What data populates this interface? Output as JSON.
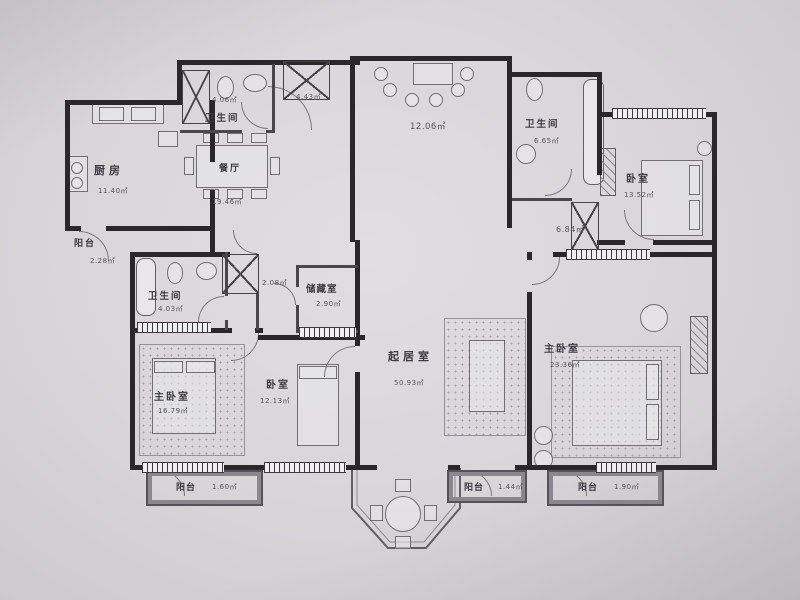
{
  "meta": {
    "kind": "residential floor plan",
    "units": "㎡"
  },
  "palette": {
    "paper": "#d9d6da",
    "wall": "#2a272a",
    "thin_line": "#716e76",
    "text": "#45444c"
  },
  "rooms": [
    {
      "id": "kitchen",
      "name": "厨房",
      "area": "11.40㎡"
    },
    {
      "id": "balcony-west",
      "name": "阳台",
      "area": "2.28㎡"
    },
    {
      "id": "bathroom-north",
      "name": "卫生间",
      "area": "4.06㎡"
    },
    {
      "id": "foyer",
      "name": "",
      "area": "4.43㎡"
    },
    {
      "id": "dining-room",
      "name": "餐厅",
      "area": "19.46㎡"
    },
    {
      "id": "family-room-north",
      "name": "",
      "area": "12.06㎡"
    },
    {
      "id": "bathroom-northeast",
      "name": "卫生间",
      "area": "6.65㎡"
    },
    {
      "id": "bedroom-northeast",
      "name": "卧室",
      "area": "13.52㎡"
    },
    {
      "id": "hallway",
      "name": "",
      "area": "6.84㎡"
    },
    {
      "id": "bathroom-west",
      "name": "卫生间",
      "area": "4.03㎡"
    },
    {
      "id": "corridor",
      "name": "",
      "area": "2.08㎡"
    },
    {
      "id": "storage-room",
      "name": "储藏室",
      "area": "2.90㎡"
    },
    {
      "id": "living-room",
      "name": "起居室",
      "area": "50.93㎡"
    },
    {
      "id": "master-bedroom-west",
      "name": "主卧室",
      "area": "16.79㎡"
    },
    {
      "id": "bedroom-south",
      "name": "卧室",
      "area": "12.13㎡"
    },
    {
      "id": "master-bedroom-east",
      "name": "主卧室",
      "area": "23.36㎡"
    },
    {
      "id": "balcony-south-west",
      "name": "阳台",
      "area": "1.60㎡"
    },
    {
      "id": "balcony-south-center",
      "name": "阳台",
      "area": "1.44㎡"
    },
    {
      "id": "balcony-south-east",
      "name": "阳台",
      "area": "1.90㎡"
    }
  ]
}
